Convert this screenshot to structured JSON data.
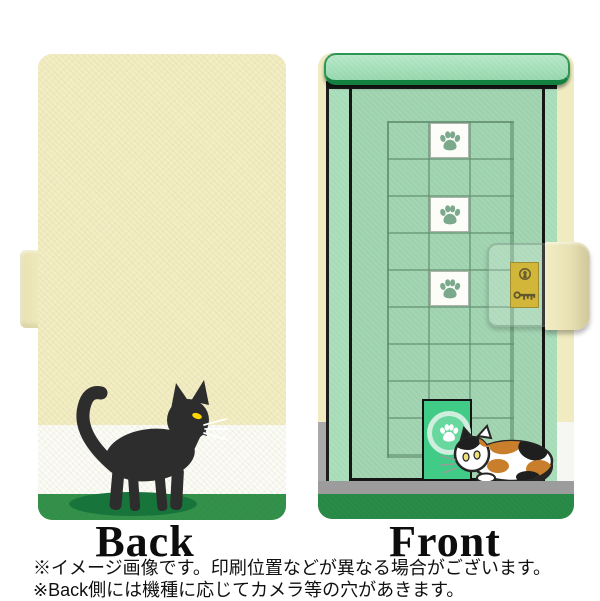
{
  "product": {
    "type": "flip-wallet phone case product image",
    "views": [
      "Back",
      "Front"
    ]
  },
  "labels": {
    "back": "Back",
    "front": "Front"
  },
  "notes": {
    "line1": "※イメージ画像です。印刷位置などが異なる場合がございます。",
    "line2": "※Back側には機種に応じてカメラ等の穴があきます。"
  },
  "back_design": {
    "background": "cream with white and green bands",
    "motif": "black cat standing facing right with raised tail, yellow eye, white whiskers, dark green shadow"
  },
  "front_design": {
    "motif": "green door with tile grid, paw-print tiles, gold key plate, cat flap door and calico cat",
    "grid": {
      "columns": 3,
      "rows": 9
    },
    "paw_tile_rows": [
      1,
      3,
      5
    ],
    "paw_tile_column": 2
  },
  "colors": {
    "case_cream": "#f2edc3",
    "back_white_band": "#fbfbf7",
    "back_green_band": "#2e9049",
    "cat_shadow_green": "#17743a",
    "black_cat": "#2d2d2d",
    "cat_eye_yellow": "#ffd800",
    "front_cover_green": "#a6dcb8",
    "door_green": "#9ed2ae",
    "top_bar_green": "#a8e0bd",
    "top_bar_border_green": "#148040",
    "grid_line_green": "#628e70",
    "paw_print_green": "#7aa98c",
    "cat_door_green": "#40cc87",
    "floor_gray": "#9c9c9c",
    "front_bottom_green": "#2a8a48",
    "lock_plate_gold": "#c8a70f",
    "calico_orange": "#c97e2b"
  }
}
